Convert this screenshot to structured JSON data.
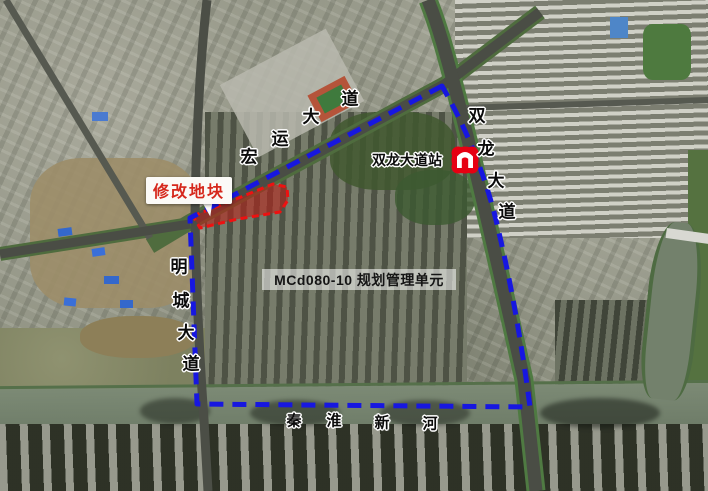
{
  "region_label": {
    "text": "MCd080-10 规划管理单元"
  },
  "modified_plot": {
    "label": "修改地块"
  },
  "station": {
    "name": "双龙大道站",
    "icon": "nanjing-metro-logo"
  },
  "roads": {
    "hongyun": {
      "name": "宏运大道",
      "chars": [
        "宏",
        "运",
        "大",
        "道"
      ]
    },
    "shuanglong": {
      "name": "双龙大道",
      "chars": [
        "双",
        "龙",
        "大",
        "道"
      ]
    },
    "mingcheng": {
      "name": "明城大道",
      "chars": [
        "明",
        "城",
        "大",
        "道"
      ]
    }
  },
  "river": {
    "name": "秦淮新河",
    "chars": [
      "秦",
      "淮",
      "新",
      "河"
    ]
  },
  "colors": {
    "boundary_blue": "#1717e0",
    "plot_stroke_red": "#ee1111",
    "plot_fill_red": "rgba(190,30,22,0.55)",
    "callout_text_red": "#d6281c",
    "metro_red": "#e60012"
  }
}
